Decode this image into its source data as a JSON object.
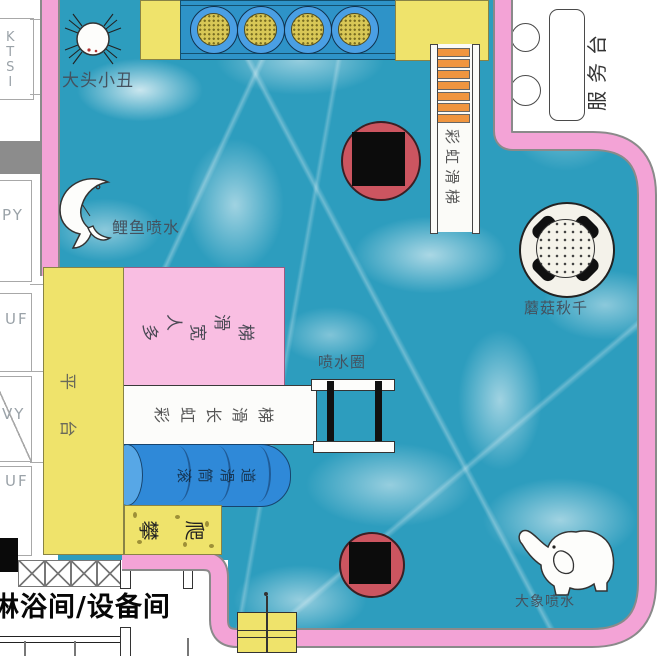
{
  "attractions": {
    "clown": "大头小丑",
    "koi_spray": "鲤鱼喷水",
    "wide_slide": "多人宽滑梯",
    "rainbow_slide": "彩虹滑梯",
    "rainbow_long_slide": "彩虹长滑梯",
    "roller_slide": "滚筒滑道",
    "climbing": "攀爬",
    "platform": "平台",
    "spray_ring": "喷水圈",
    "mushroom_swing": "蘑菇秋千",
    "elephant_spray": "大象喷水"
  },
  "service_desk": "服务台",
  "building": {
    "room_label": "淋浴间/设备间",
    "side_codes": [
      "KTSI",
      "PY",
      "UF",
      "VY",
      "UF"
    ]
  },
  "icons": {
    "clown": "clown-face-icon",
    "koi": "fish-icon",
    "elephant": "elephant-icon",
    "mushroom": "mushroom-swing-top",
    "red_feature": "tipping-bucket"
  },
  "colors": {
    "pool_water": "#2D9DBE",
    "border_pink": "#F3A3D6",
    "slide_pink": "#F9BEE2",
    "deck_yellow": "#EFE36B",
    "cylinder_blue": "#2F89D8",
    "bubble_ring_blue": "#4A9FE4",
    "bubble_center_yellow": "#D8C756",
    "red_feature": "#CC5560",
    "ladder_orange": "#F0953F"
  }
}
